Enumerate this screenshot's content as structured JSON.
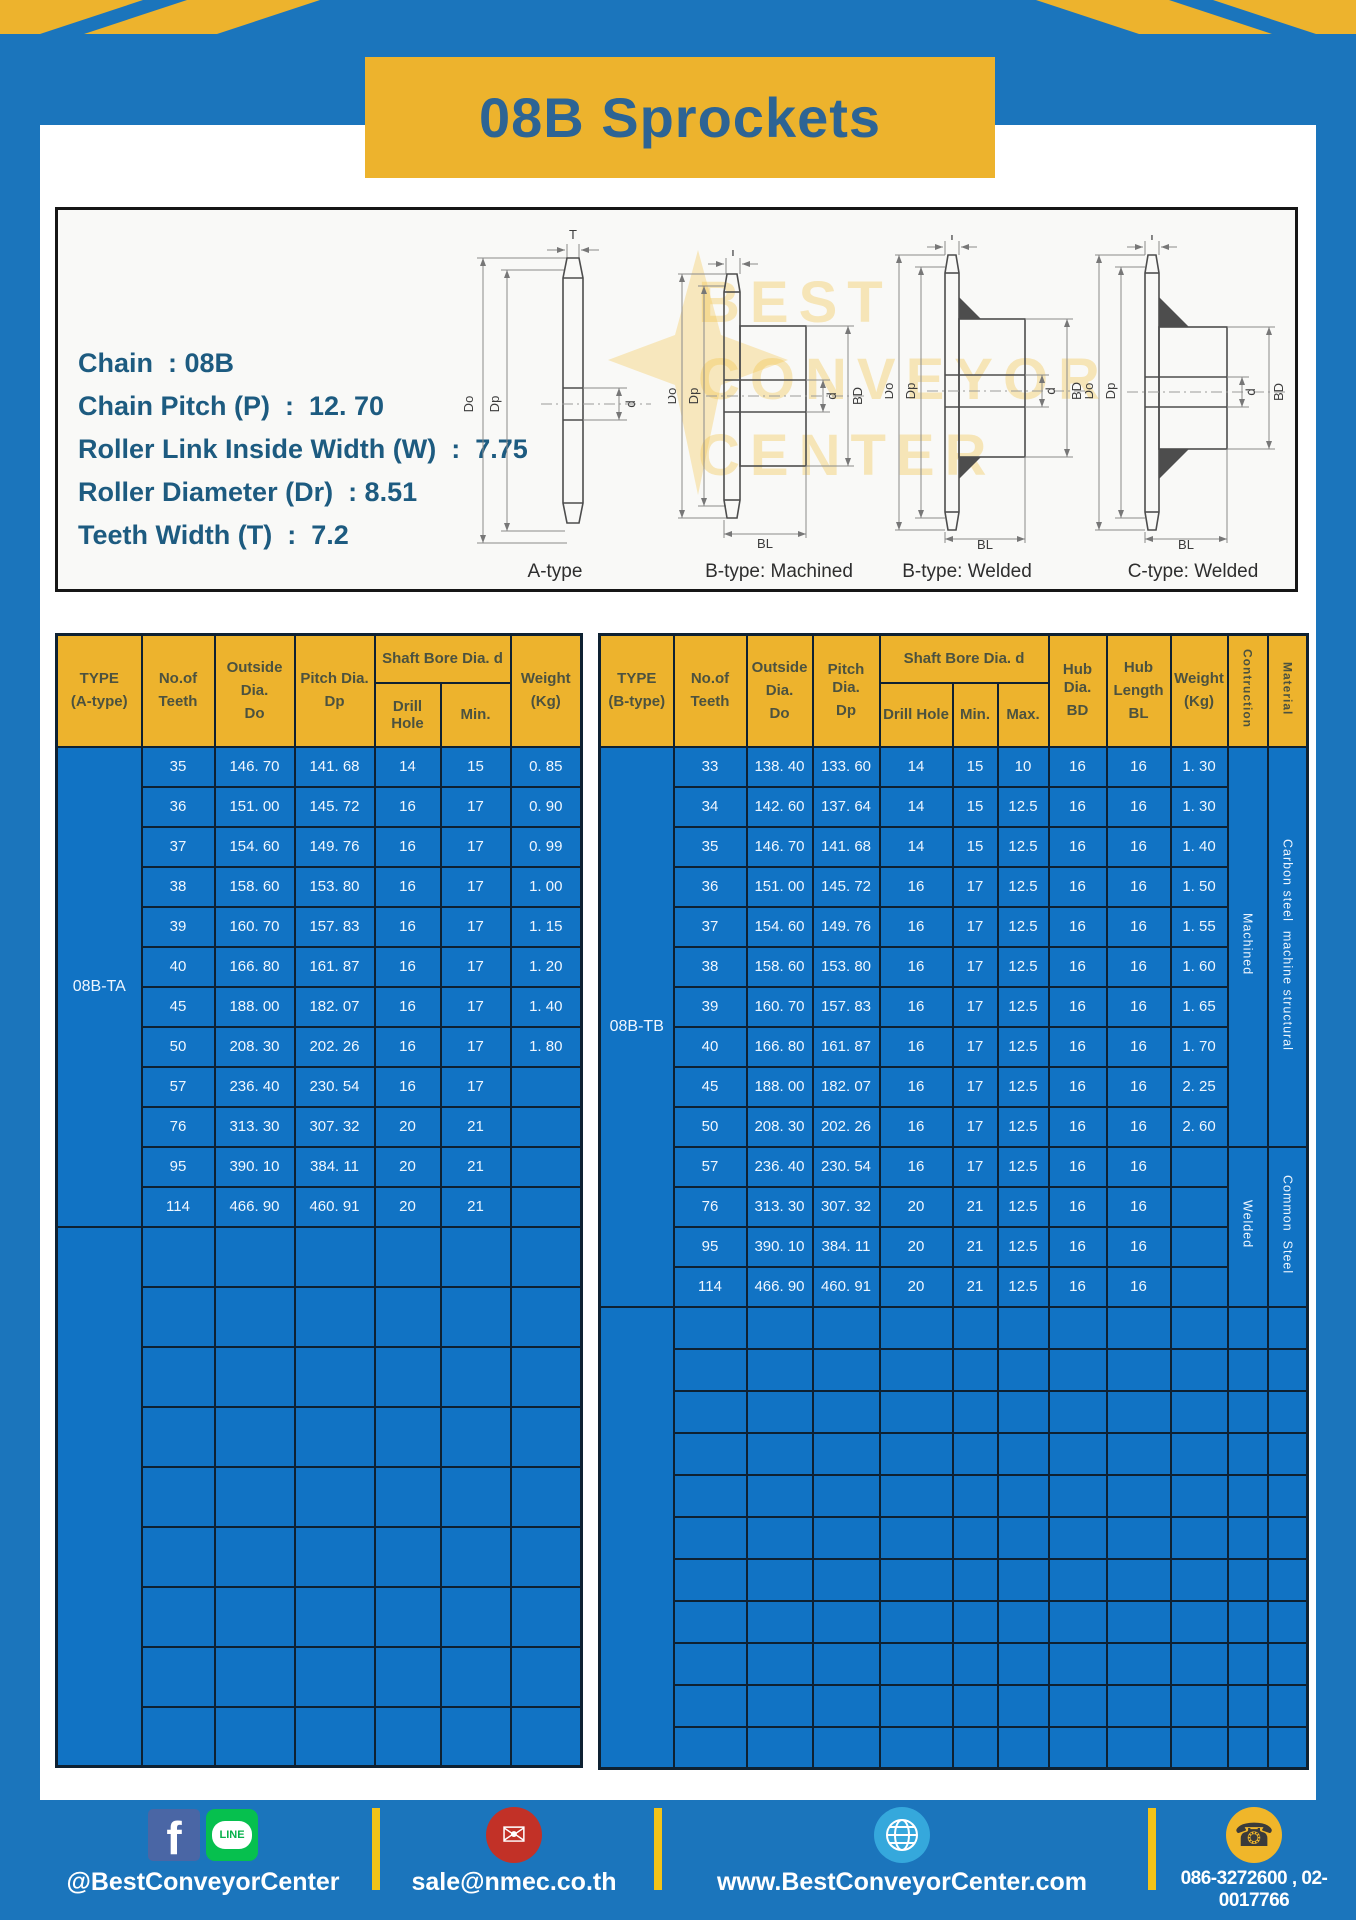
{
  "title": "08B Sprockets",
  "specs": [
    "Chain  : 08B",
    "Chain Pitch (P)  :  12. 70",
    "Roller Link Inside Width (W)  :  7.75",
    "Roller Diameter (Dr)  : 8.51",
    "Teeth Width (T)  :  7.2"
  ],
  "diagram": {
    "captions": [
      "A-type",
      "B-type: Machined",
      "B-type: Welded",
      "C-type: Welded"
    ],
    "dim_labels": {
      "t": "T",
      "outer": "Do",
      "pitch": "Dp",
      "bore": "d",
      "hub": "BD",
      "hub_len": "BL"
    },
    "watermark": [
      "BEST",
      "CONVEYOR",
      "CENTER"
    ]
  },
  "table_a": {
    "header": {
      "type1": "TYPE",
      "type2": "(A-type)",
      "noof": "No.of",
      "teeth": "Teeth",
      "out1": "Outside",
      "out2": "Dia.",
      "out3": "Do",
      "pitch1": "Pitch Dia.",
      "pitch2": "Dp",
      "shaft": "Shaft Bore Dia. d",
      "drill": "Drill Hole",
      "min": "Min.",
      "w1": "Weight",
      "w2": "(Kg)"
    },
    "type_label": "08B-TA",
    "rows": [
      [
        "35",
        "146. 70",
        "141. 68",
        "14",
        "15",
        "0. 85"
      ],
      [
        "36",
        "151. 00",
        "145. 72",
        "16",
        "17",
        "0. 90"
      ],
      [
        "37",
        "154. 60",
        "149. 76",
        "16",
        "17",
        "0. 99"
      ],
      [
        "38",
        "158. 60",
        "153. 80",
        "16",
        "17",
        "1. 00"
      ],
      [
        "39",
        "160. 70",
        "157. 83",
        "16",
        "17",
        "1. 15"
      ],
      [
        "40",
        "166. 80",
        "161. 87",
        "16",
        "17",
        "1. 20"
      ],
      [
        "45",
        "188. 00",
        "182. 07",
        "16",
        "17",
        "1. 40"
      ],
      [
        "50",
        "208. 30",
        "202. 26",
        "16",
        "17",
        "1. 80"
      ],
      [
        "57",
        "236. 40",
        "230. 54",
        "16",
        "17",
        ""
      ],
      [
        "76",
        "313. 30",
        "307. 32",
        "20",
        "21",
        ""
      ],
      [
        "95",
        "390. 10",
        "384. 11",
        "20",
        "21",
        ""
      ],
      [
        "114",
        "466. 90",
        "460. 91",
        "20",
        "21",
        ""
      ]
    ]
  },
  "table_b": {
    "header": {
      "type1": "TYPE",
      "type2": "(B-type)",
      "noof": "No.of",
      "teeth": "Teeth",
      "out1": "Outside",
      "out2": "Dia.",
      "out3": "Do",
      "pitch1": "Pitch Dia.",
      "pitch2": "Dp",
      "shaft": "Shaft Bore Dia. d",
      "drill": "Drill Hole",
      "min": "Min.",
      "max": "Max.",
      "hub1": "Hub Dia.",
      "hub2": "BD",
      "hl1": "Hub",
      "hl2": "Length",
      "hl3": "BL",
      "w1": "Weight",
      "w2": "(Kg)",
      "contruction": "Contruction",
      "material": "Material"
    },
    "type_label": "08B-TB",
    "construction": {
      "machined": "Machined",
      "welded": "Welded"
    },
    "materials": {
      "upper": "Carbon steel  machine structural",
      "lower": "Common  Steel"
    },
    "rows": [
      [
        "33",
        "138. 40",
        "133. 60",
        "14",
        "15",
        "10",
        "16",
        "16",
        "1. 30"
      ],
      [
        "34",
        "142. 60",
        "137. 64",
        "14",
        "15",
        "12.5",
        "16",
        "16",
        "1. 30"
      ],
      [
        "35",
        "146. 70",
        "141. 68",
        "14",
        "15",
        "12.5",
        "16",
        "16",
        "1. 40"
      ],
      [
        "36",
        "151. 00",
        "145. 72",
        "16",
        "17",
        "12.5",
        "16",
        "16",
        "1. 50"
      ],
      [
        "37",
        "154. 60",
        "149. 76",
        "16",
        "17",
        "12.5",
        "16",
        "16",
        "1. 55"
      ],
      [
        "38",
        "158. 60",
        "153. 80",
        "16",
        "17",
        "12.5",
        "16",
        "16",
        "1. 60"
      ],
      [
        "39",
        "160. 70",
        "157. 83",
        "16",
        "17",
        "12.5",
        "16",
        "16",
        "1. 65"
      ],
      [
        "40",
        "166. 80",
        "161. 87",
        "16",
        "17",
        "12.5",
        "16",
        "16",
        "1. 70"
      ],
      [
        "45",
        "188. 00",
        "182. 07",
        "16",
        "17",
        "12.5",
        "16",
        "16",
        "2. 25"
      ],
      [
        "50",
        "208. 30",
        "202. 26",
        "16",
        "17",
        "12.5",
        "16",
        "16",
        "2. 60"
      ],
      [
        "57",
        "236. 40",
        "230. 54",
        "16",
        "17",
        "12.5",
        "16",
        "16",
        ""
      ],
      [
        "76",
        "313. 30",
        "307. 32",
        "20",
        "21",
        "12.5",
        "16",
        "16",
        ""
      ],
      [
        "95",
        "390. 10",
        "384. 11",
        "20",
        "21",
        "12.5",
        "16",
        "16",
        ""
      ],
      [
        "114",
        "466. 90",
        "460. 91",
        "20",
        "21",
        "12.5",
        "16",
        "16",
        ""
      ]
    ]
  },
  "footer": {
    "fb_glyph": "f",
    "line_label": "LINE",
    "mail_glyph": "✉",
    "phone_glyph": "☎",
    "social_label": "@BestConveyorCenter",
    "email": "sale@nmec.co.th",
    "website": "www.BestConveyorCenter.com",
    "phones": "086-3272600 , 02-0017766"
  },
  "colors": {
    "frame_blue": "#1b75bc",
    "accent_yellow": "#edb32d",
    "cell_blue": "#1173c4",
    "grid_navy": "#0e2132",
    "title_text": "#2d6494",
    "spec_text": "#1d5b80"
  }
}
